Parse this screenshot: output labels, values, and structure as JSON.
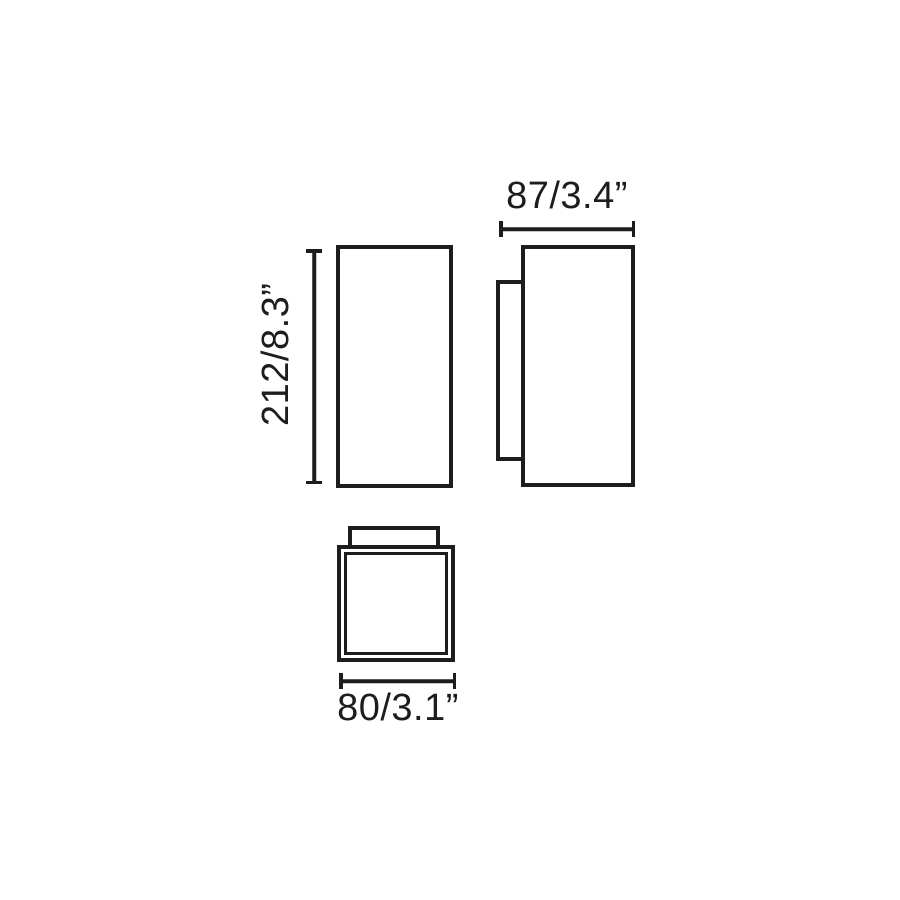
{
  "colors": {
    "ink": "#1d1d1b",
    "background": "#ffffff"
  },
  "dimensions": {
    "height": {
      "label": "212/8.3”",
      "mm": 212,
      "inches": 8.3
    },
    "depth": {
      "label": "87/3.4”",
      "mm": 87,
      "inches": 3.4
    },
    "width": {
      "label": "80/3.1”",
      "mm": 80,
      "inches": 3.1
    }
  }
}
